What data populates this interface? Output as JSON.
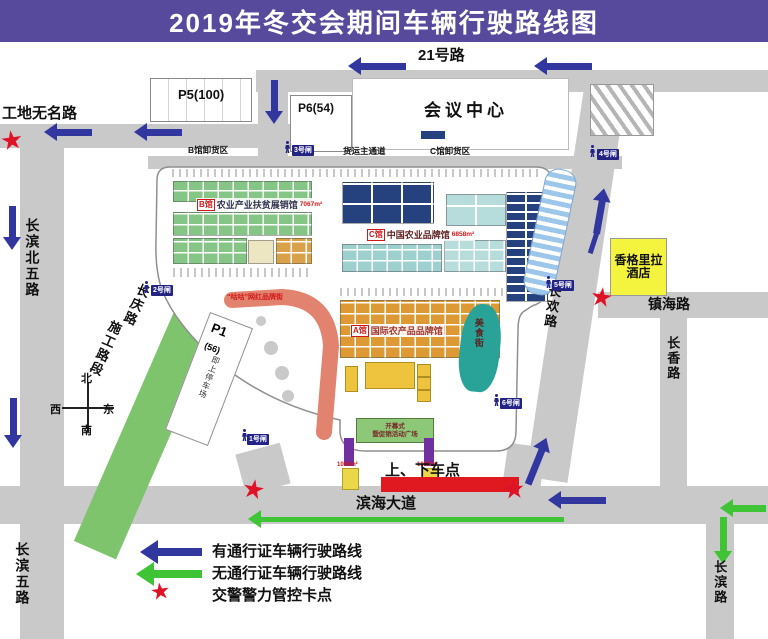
{
  "title": "2019年冬交会期间车辆行驶路线图",
  "roads": {
    "r21": "21号路",
    "gongdi": "工地无名路",
    "cbn5": "长滨北五路",
    "cq": "长庆路",
    "shigong": "施工路段",
    "binhai": "滨海大道",
    "zhenhai": "镇海路",
    "changhuan": "长欢路",
    "changxiang": "长香路",
    "cb5": "长滨五路",
    "changbin": "长滨路"
  },
  "buildings": {
    "p5": "P5(100)",
    "p6": "P6(54)",
    "conference": "会议中心",
    "hotel1": "香格里拉",
    "hotel2": "酒店",
    "p1": "P1",
    "p1_cap": "(56)",
    "p1_note": "即上停车场"
  },
  "zones": {
    "b_unload": "B馆卸货区",
    "freight": "货运主通道",
    "c_unload": "C馆卸货区",
    "hallB_tag": "B馆",
    "hallB_name": "农业产业扶贫展销馆",
    "hallB_area": "7067m²",
    "hallC_tag": "C馆",
    "hallC_name": "中国农业品牌馆",
    "hallC_area": "6858m²",
    "hallA_tag": "A馆",
    "hallA_name": "国际农产品品牌馆",
    "food": "美食街",
    "brand": "“咕咕”网红品牌街",
    "open1": "开幕式",
    "open2": "暨促销活动广场",
    "dropoff": "上、下车点",
    "temp1": "1000m²",
    "temp2": "1000m²"
  },
  "gates": {
    "g1": "1号闸",
    "g2": "2号闸",
    "g3": "3号闸",
    "g4": "4号闸",
    "g5": "5号闸",
    "g6": "6号闸"
  },
  "compass": {
    "n": "北",
    "s": "南",
    "e": "东",
    "w": "西"
  },
  "legend": {
    "pass": "有通行证车辆行驶路线",
    "nopass": "无通行证车辆行驶路线",
    "police": "交警警力管控卡点"
  },
  "colors": {
    "title_purple": "#574a9d",
    "route_with_pass": "#3237a0",
    "route_without_pass": "#3fc435",
    "checkpoint_red": "#e01226",
    "hotel_yellow": "#f4f43e",
    "road_gray": "#c9c9ca",
    "construction_green": "#7ec46d"
  }
}
